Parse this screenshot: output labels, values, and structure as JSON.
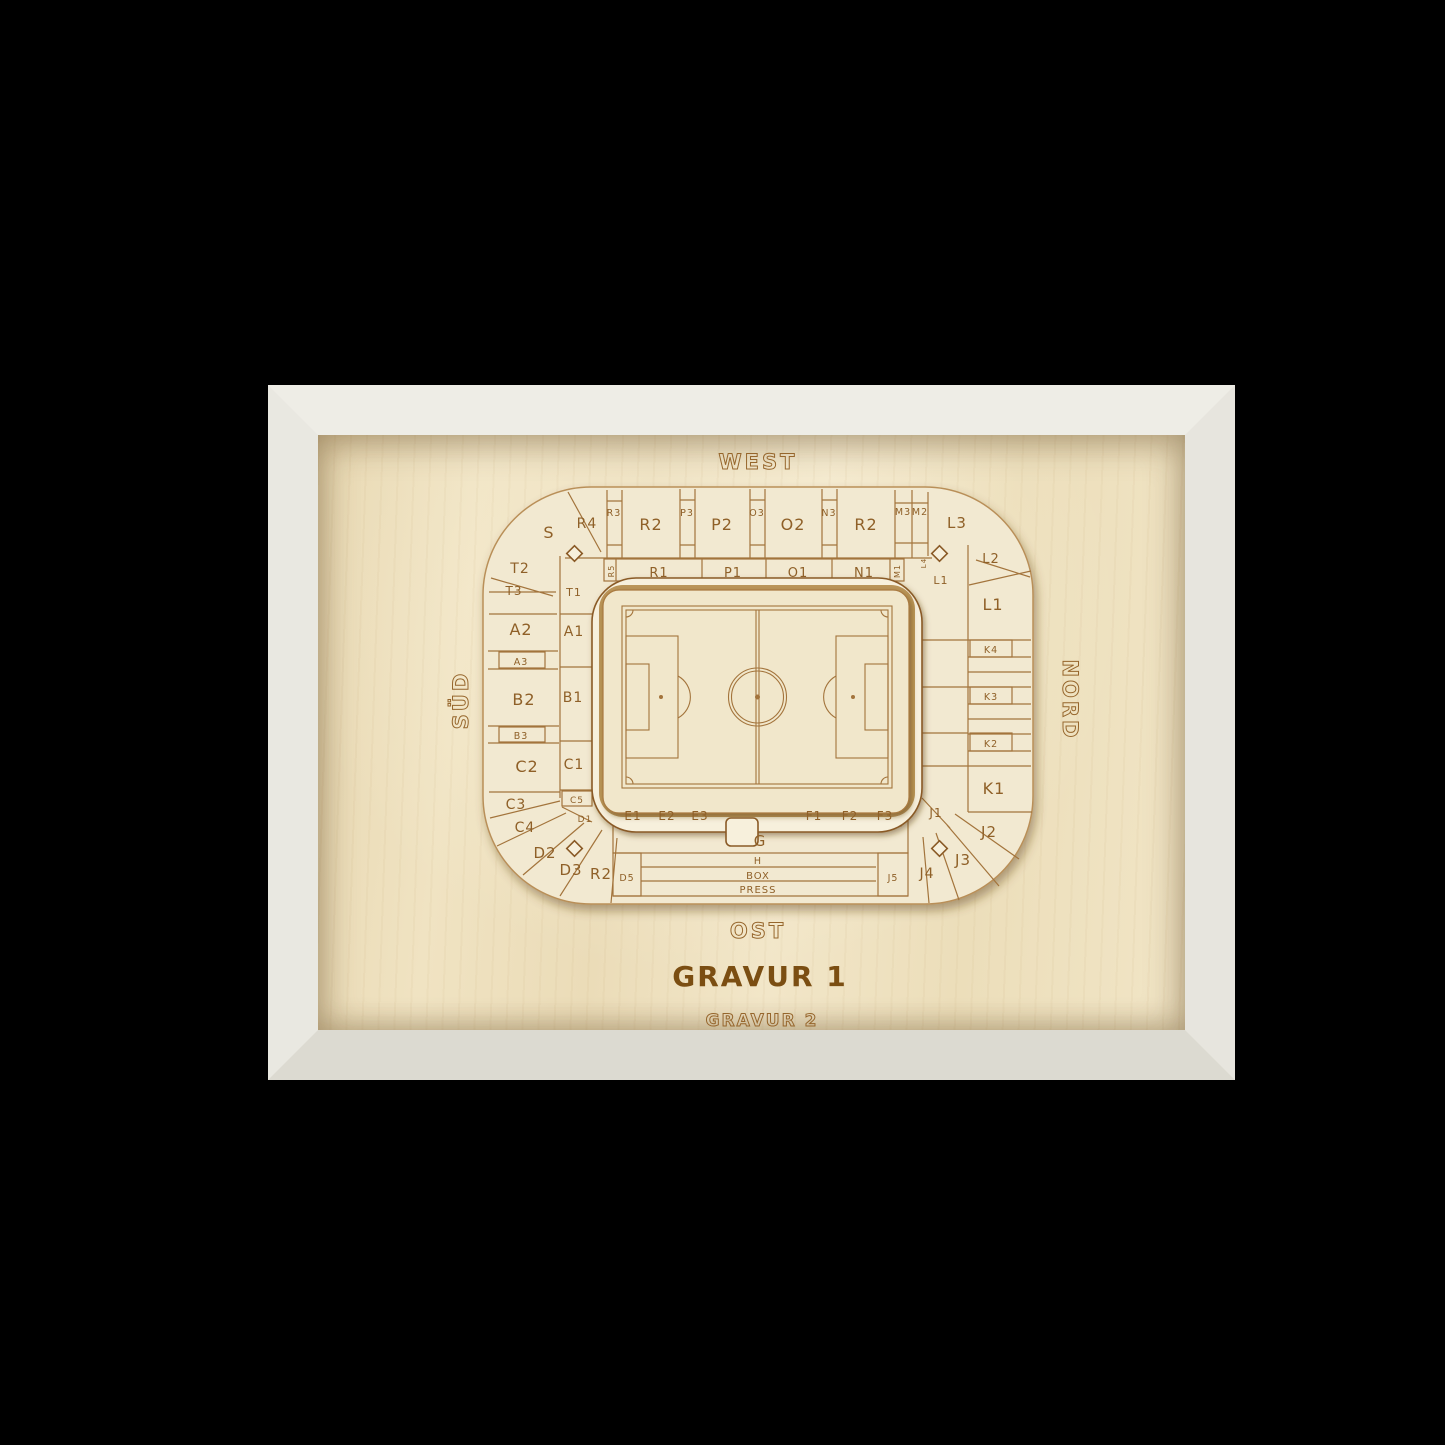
{
  "colors": {
    "background": "#000000",
    "frame_white": "#e9e8e1",
    "backboard_wood": "#eedfbe",
    "plate_wood": "#f2e9d1",
    "engraving_brown": "#a3743c",
    "label_brown": "#8f6028",
    "gravur1_fill": "#7b4e12"
  },
  "stadium": {
    "stands": {
      "west": "WEST",
      "sued": "SÜD",
      "nord": "NORD",
      "ost": "OST"
    },
    "gravur1": "GRAVUR 1",
    "gravur2": "GRAVUR 2",
    "sections": {
      "top_outer": [
        "R4",
        "R3",
        "R2",
        "P3",
        "P2",
        "O3",
        "O2",
        "N3",
        "R2",
        "M3",
        "M2",
        "L3"
      ],
      "top_inner": [
        "R5",
        "R1",
        "P1",
        "O1",
        "N1",
        "M1"
      ],
      "left_outer": [
        "S",
        "T2",
        "T3",
        "A2",
        "A3",
        "B2",
        "B3",
        "C2",
        "C3",
        "C4",
        "D2",
        "D3",
        "R2"
      ],
      "left_inner": [
        "T1",
        "A1",
        "B1",
        "C1",
        "C5",
        "D1"
      ],
      "right_outer": [
        "L2",
        "L1",
        "K4",
        "K3",
        "K2",
        "K1",
        "J2",
        "J3",
        "J4"
      ],
      "right_inner": [
        "L4",
        "L1",
        "J1",
        "J5"
      ],
      "bottom_inner": [
        "E1",
        "E2",
        "E3",
        "G",
        "F1",
        "F2",
        "F3"
      ],
      "bottom_strips": [
        "H",
        "BOX",
        "PRESS"
      ],
      "bottom_strip_left": "D5"
    }
  }
}
